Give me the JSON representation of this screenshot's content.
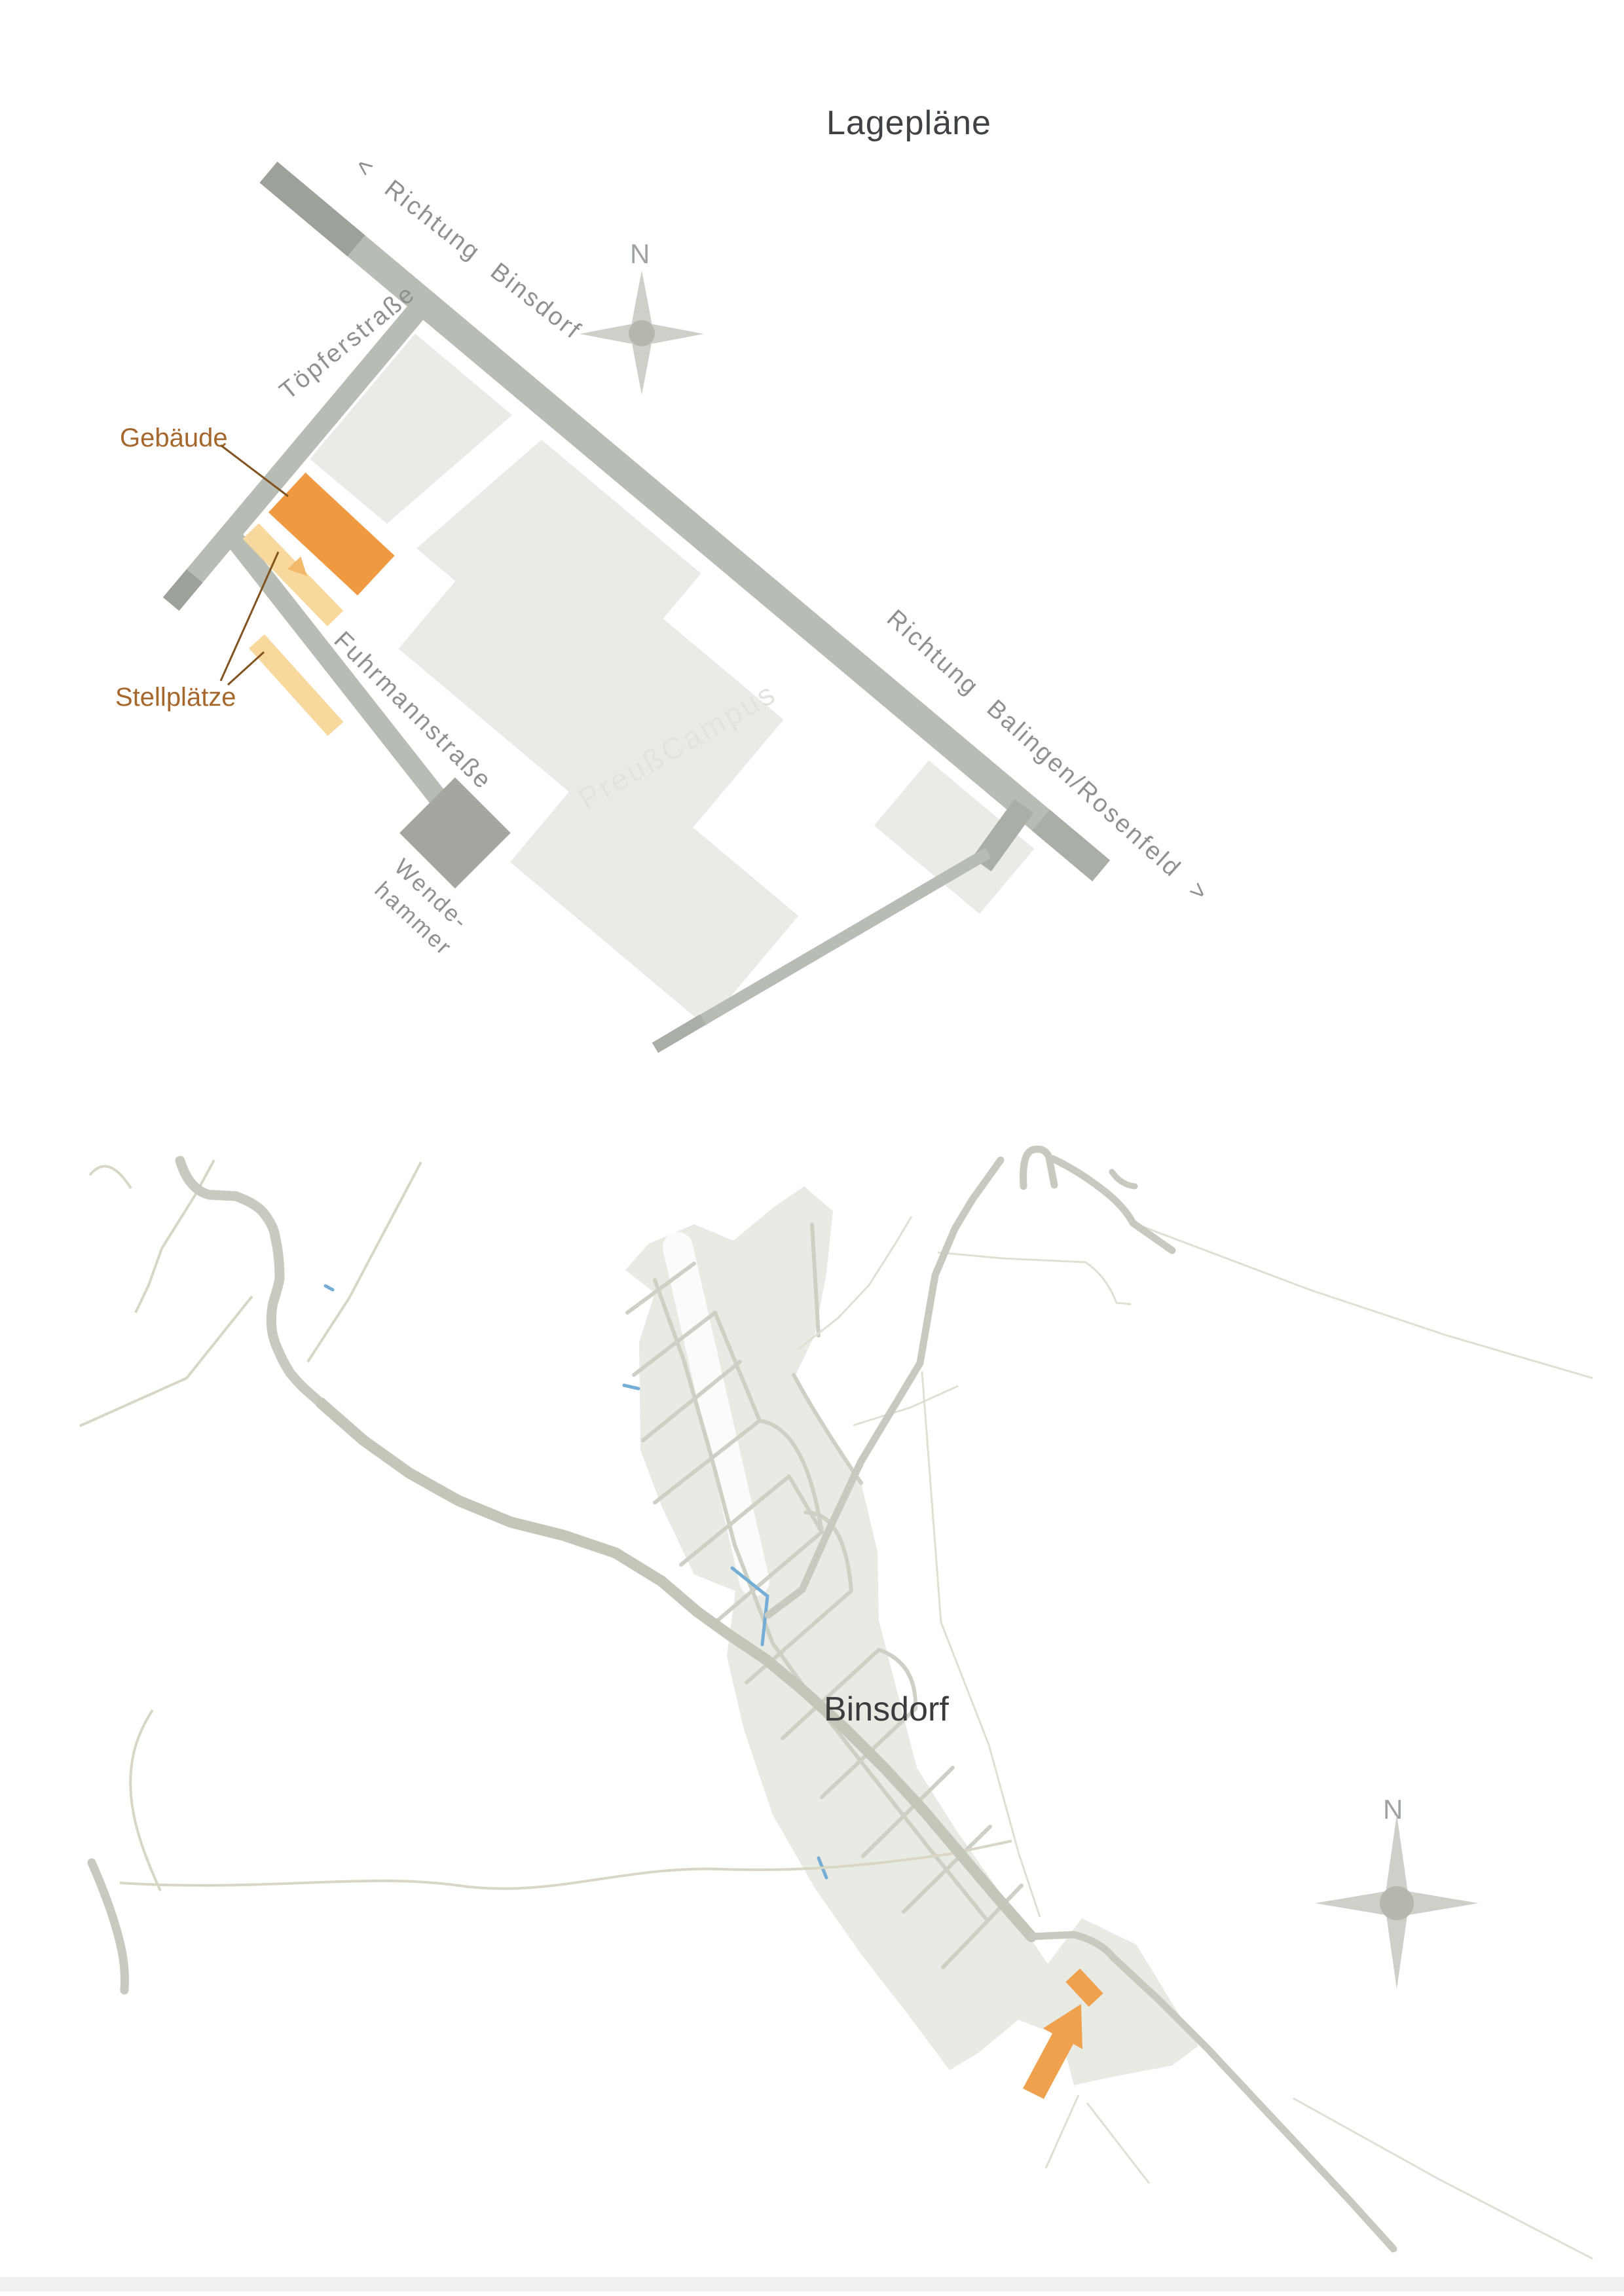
{
  "page": {
    "title": "Lagepläne"
  },
  "site_plan": {
    "street_labels": {
      "direction_nw": "< Richtung  Binsdorf",
      "direction_se": "Richtung  Balingen/Rosenfeld >",
      "topferstrasse": "Töpferstraße",
      "fuhrmannstrasse": "Fuhrmannstraße",
      "wendehammer_line1": "Wende-",
      "wendehammer_line2": "hammer"
    },
    "callouts": {
      "building": "Gebäude",
      "parking": "Stellplätze"
    },
    "watermark": "PreußCampus",
    "compass": "N"
  },
  "area_map": {
    "place": "Binsdorf",
    "compass": "N"
  },
  "colors": {
    "road_gray": "#b7bcb4",
    "road_dark_gray": "#9ca19a",
    "campus_block": "#e9ebe6",
    "building_orange": "#ef9a41",
    "parking_pale_orange": "#f8d89c",
    "callout_brown": "#a5672c",
    "street_label_gray": "#8e928f",
    "village_fill": "#e8eae4",
    "village_street": "#cdd1c5",
    "creek_blue": "#74aed6",
    "arrow_orange": "#f0a14e",
    "title_dark": "#3f4245"
  }
}
